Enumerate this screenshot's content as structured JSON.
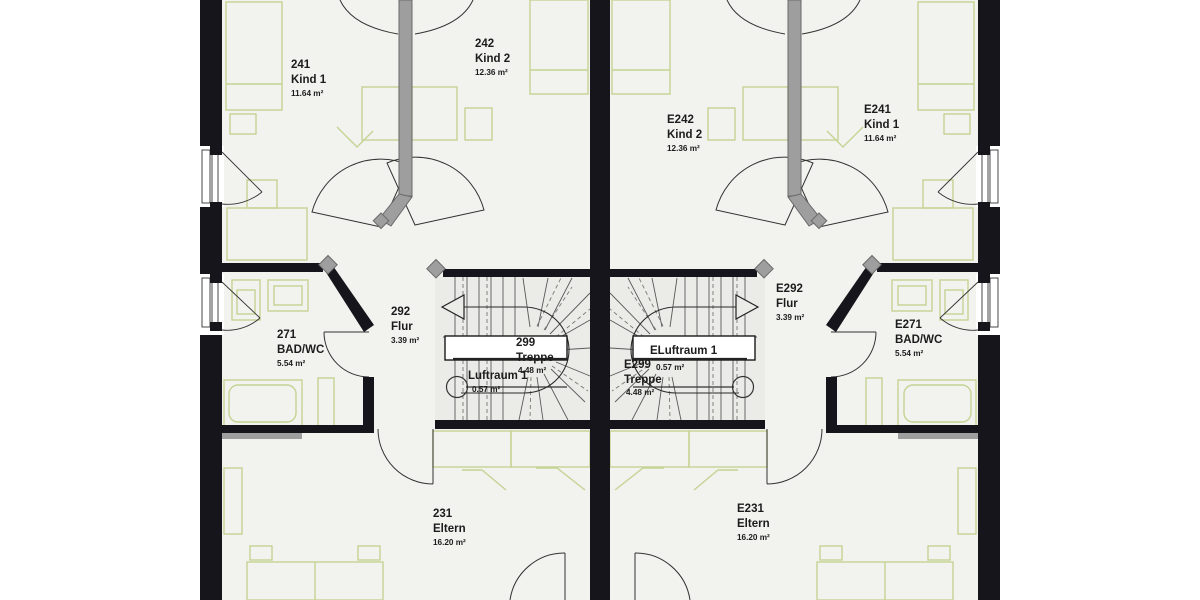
{
  "plan": {
    "type": "floor-plan",
    "units": [
      {
        "name": "left-unit",
        "rooms": [
          {
            "number": "241",
            "label": "Kind 1",
            "area": "11.64 m²"
          },
          {
            "number": "242",
            "label": "Kind 2",
            "area": "12.36 m²"
          },
          {
            "number": "271",
            "label": "BAD/WC",
            "area": "5.54 m²"
          },
          {
            "number": "292",
            "label": "Flur",
            "area": "3.39 m²"
          },
          {
            "number": "299",
            "label": "Treppe",
            "area": "4.48 m²"
          },
          {
            "number": "231",
            "label": "Eltern",
            "area": "16.20 m²"
          },
          {
            "label": "Luftraum 1",
            "area": "0.57 m²"
          }
        ]
      },
      {
        "name": "right-unit",
        "rooms": [
          {
            "number": "E242",
            "label": "Kind 2",
            "area": "12.36 m²"
          },
          {
            "number": "E241",
            "label": "Kind 1",
            "area": "11.64 m²"
          },
          {
            "number": "E271",
            "label": "BAD/WC",
            "area": "5.54 m²"
          },
          {
            "number": "E292",
            "label": "Flur",
            "area": "3.39 m²"
          },
          {
            "number": "E299",
            "label": "Treppe",
            "area": "4.48 m²"
          },
          {
            "number": "E231",
            "label": "Eltern",
            "area": "16.20 m²"
          },
          {
            "label": "ELuftraum 1",
            "area": "0.57 m²"
          }
        ]
      }
    ]
  },
  "colors": {
    "wall": "#15151b",
    "floor": "#f2f2ef",
    "stair_floor": "#ebebe7",
    "furniture": "#c5d393",
    "chimney": "#9e9e9e",
    "line": "#333333",
    "text": "#1c1c1c"
  }
}
